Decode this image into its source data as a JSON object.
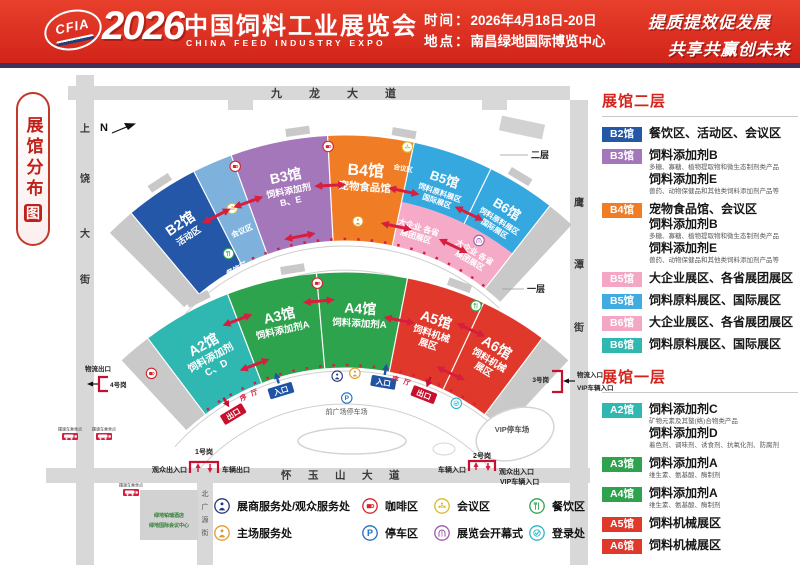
{
  "header": {
    "logo": "CFIA",
    "year": "2026",
    "title_cn": "中国饲料工业展览会",
    "title_en": "CHINA FEED INDUSTRY EXPO",
    "time_label": "时间：",
    "time_value": "2026年4月18日-20日",
    "venue_label": "地点：",
    "venue_value": "南昌绿地国际博览中心",
    "slogan1": "提质提效促发展",
    "slogan2": "共享共赢创未来"
  },
  "map_badge": {
    "text": "展馆分布",
    "boxed": "图"
  },
  "sidebar": {
    "floor2": {
      "title": "展馆二层",
      "items": [
        {
          "badge": "B2馆",
          "color": "#2457a7",
          "rows": [
            {
              "b": "餐饮区、活动区、会议区"
            }
          ]
        },
        {
          "badge": "B3馆",
          "color": "#a476ba",
          "rows": [
            {
              "b": "饲料添加剂B"
            },
            {
              "s": "多糖、寡糖、植物提取物和微生态制剂类产品"
            },
            {
              "b": "饲料添加剂E"
            },
            {
              "s": "兽药、动物保健品和其他类饲料添加剂产品等"
            }
          ]
        },
        {
          "badge": "B4馆",
          "color": "#f07d26",
          "rows": [
            {
              "b": "宠物食品馆、会议区"
            },
            {
              "b": "饲料添加剂B"
            },
            {
              "s": "多糖、寡糖、植物提取物和微生态制剂类产品"
            },
            {
              "b": "饲料添加剂E"
            },
            {
              "s": "兽药、动物保健品和其他类饲料添加剂产品等"
            }
          ]
        },
        {
          "badge": "B5馆",
          "color": "#f3a7c4",
          "rows": [
            {
              "b": "大企业展区、各省展团展区"
            }
          ]
        },
        {
          "badge": "B5馆",
          "color": "#3fabe1",
          "rows": [
            {
              "b": "饲料原料展区、国际展区"
            }
          ]
        },
        {
          "badge": "B6馆",
          "color": "#f3a7c4",
          "rows": [
            {
              "b": "大企业展区、各省展团展区"
            }
          ]
        },
        {
          "badge": "B6馆",
          "color": "#2fb7b1",
          "rows": [
            {
              "b": "饲料原料展区、国际展区"
            }
          ]
        }
      ]
    },
    "floor1": {
      "title": "展馆一层",
      "items": [
        {
          "badge": "A2馆",
          "color": "#2fb7b1",
          "rows": [
            {
              "b": "饲料添加剂C"
            },
            {
              "s": "矿物元素及其螯(络)合物类产品"
            },
            {
              "b": "饲料添加剂D"
            },
            {
              "s": "着色剂、调味剂、诱食剂、抗氧化剂、防腐剂"
            }
          ]
        },
        {
          "badge": "A3馆",
          "color": "#2ea34d",
          "rows": [
            {
              "b": "饲料添加剂A"
            },
            {
              "s": "维生素、氨基酸、酶制剂"
            }
          ]
        },
        {
          "badge": "A4馆",
          "color": "#2ea34d",
          "rows": [
            {
              "b": "饲料添加剂A"
            },
            {
              "s": "维生素、氨基酸、酶制剂"
            }
          ]
        },
        {
          "badge": "A5馆",
          "color": "#e0392c",
          "rows": [
            {
              "b": "饲料机械展区"
            }
          ]
        },
        {
          "badge": "A6馆",
          "color": "#e0392c",
          "rows": [
            {
              "b": "饲料机械展区"
            }
          ]
        }
      ]
    }
  },
  "legend": {
    "items": [
      {
        "icon": "service-blue",
        "color": "#27357e",
        "label": "展商服务处/观众服务处"
      },
      {
        "icon": "coffee",
        "color": "#d6242e",
        "label": "咖啡区"
      },
      {
        "icon": "meeting",
        "color": "#d9b92e",
        "label": "会议区"
      },
      {
        "icon": "dining",
        "color": "#2ea34d",
        "label": "餐饮区"
      },
      {
        "icon": "service-orange",
        "color": "#e09b2d",
        "label": "主场服务处"
      },
      {
        "icon": "parking",
        "color": "#1d6fc0",
        "label": "停车区"
      },
      {
        "icon": "ceremony",
        "color": "#9b59a8",
        "label": "展览会开幕式"
      },
      {
        "icon": "registration",
        "color": "#2ab5c9",
        "label": "登录处"
      }
    ]
  },
  "map": {
    "compass": "N",
    "streets": {
      "top": "九龙大道",
      "left": "上饶大街",
      "right": "鹰潭街",
      "bottom": "怀玉山大道",
      "bottom_left": "北广源街"
    },
    "floor_labels": {
      "upper": "二层",
      "lower": "一层"
    },
    "halls_upper": [
      {
        "id": "B2",
        "name": "B2馆",
        "subs": [
          "活动区"
        ],
        "color": "#2457a7"
      },
      {
        "id": "B3",
        "name": "B3馆",
        "subs": [
          "饲料添加剂",
          "B、E"
        ],
        "color": "#a476ba"
      },
      {
        "id": "B4",
        "name": "B4馆",
        "subs": [
          "宠物食品馆"
        ],
        "color": "#f07d26"
      },
      {
        "id": "B5",
        "name": "B5馆",
        "subs": [
          "饲料原料展区",
          "国际展区"
        ],
        "color": "#36a8e0"
      },
      {
        "id": "B6",
        "name": "B6馆",
        "subs": [
          "饲料原料展区",
          "国际展区"
        ],
        "color": "#36a8e0"
      }
    ],
    "halls_lower": [
      {
        "id": "A2",
        "name": "A2馆",
        "subs": [
          "饲料添加剂",
          "C、D"
        ],
        "color": "#2fb7b1"
      },
      {
        "id": "A3",
        "name": "A3馆",
        "subs": [
          "饲料添加剂A"
        ],
        "color": "#2ea34d"
      },
      {
        "id": "A4",
        "name": "A4馆",
        "subs": [
          "饲料添加剂A"
        ],
        "color": "#2ea34d"
      },
      {
        "id": "A5",
        "name": "A5馆",
        "subs": [
          "饲料机械",
          "展区"
        ],
        "color": "#e0392c"
      },
      {
        "id": "A6",
        "name": "A6馆",
        "subs": [
          "饲料机械",
          "展区"
        ],
        "color": "#e0392c"
      }
    ],
    "annex_color": "#7eb1db",
    "cap_color": "#c9c9c9",
    "pink_band": {
      "color": "#f5abc7",
      "line1": "大企业  各省",
      "line2": "展团展区"
    },
    "small": {
      "enter": "入口",
      "exit": "出口",
      "xuting": "序厅",
      "meeting": "会议区",
      "dining": "餐饮区",
      "plaza_parking": "前广场停车场",
      "vip_parking": "VIP停车场",
      "hotel1": "绿地铂瑞酒店",
      "hotel2": "绿地国际会议中心",
      "shuttle": "摆渡车乘坐点"
    },
    "gates": {
      "g1": {
        "name": "1号岗",
        "left": "观众出入口",
        "right": "车辆出口"
      },
      "g2": {
        "name": "2号岗",
        "left": "车辆入口",
        "right1": "观众出入口",
        "right2": "VIP车辆入口"
      },
      "g3": {
        "name": "3号岗",
        "line1": "物流入口",
        "line2": "VIP车辆入口"
      },
      "g4": {
        "name": "4号岗",
        "label": "物流出口"
      }
    }
  }
}
